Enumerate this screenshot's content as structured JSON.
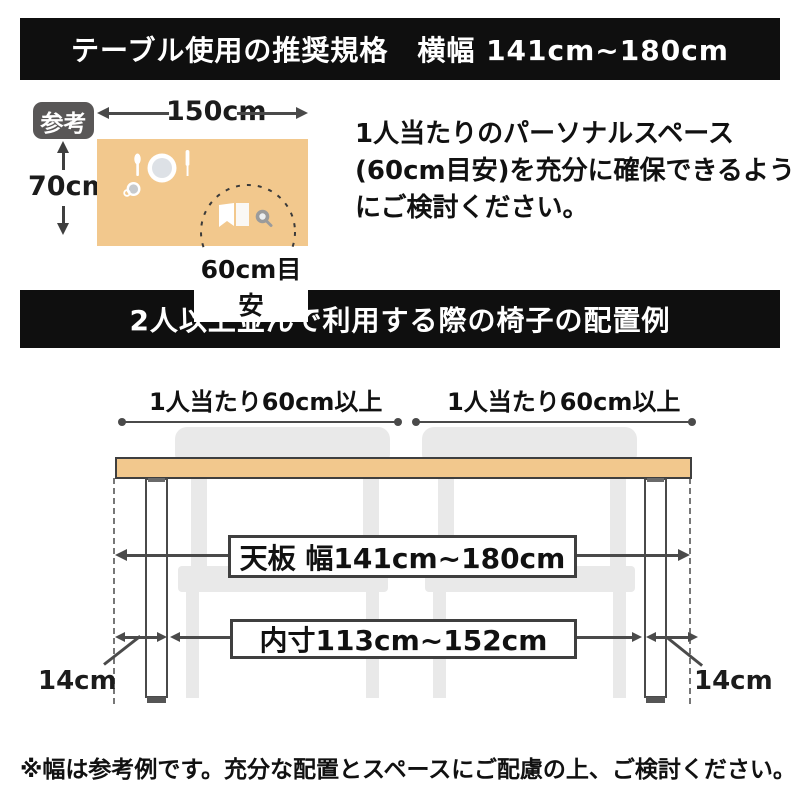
{
  "colors": {
    "banner_bg": "#0f0f0f",
    "banner_text": "#ffffff",
    "table_fill": "#f2c88d",
    "table_border": "#3f3f3f",
    "chair_fill": "#e9e9e9",
    "badge_bg": "#595757",
    "dimension_line": "#4a4a4a",
    "text": "#111111"
  },
  "banners": {
    "top": "テーブル使用の推奨規格　横幅 141cm~180cm",
    "middle": "2人以上並んで利用する際の椅子の配置例"
  },
  "reference": {
    "badge_label": "参考",
    "table_width_label": "150cm",
    "table_depth_label": "70cm",
    "personal_space_label": "60cm目安",
    "description": "1人当たりのパーソナルスペース(60cm目安)を充分に確保できるようにご検討ください。"
  },
  "arrangement": {
    "per_person_labels": [
      "1人当たり60cm以上",
      "1人当たり60cm以上"
    ],
    "tabletop_width_label": "天板 幅141cm~180cm",
    "inner_width_label": "内寸113cm~152cm",
    "leg_offset_labels": [
      "14cm",
      "14cm"
    ]
  },
  "footnote": "※幅は参考例です。充分な配置とスペースにご配慮の上、ご検討ください。"
}
